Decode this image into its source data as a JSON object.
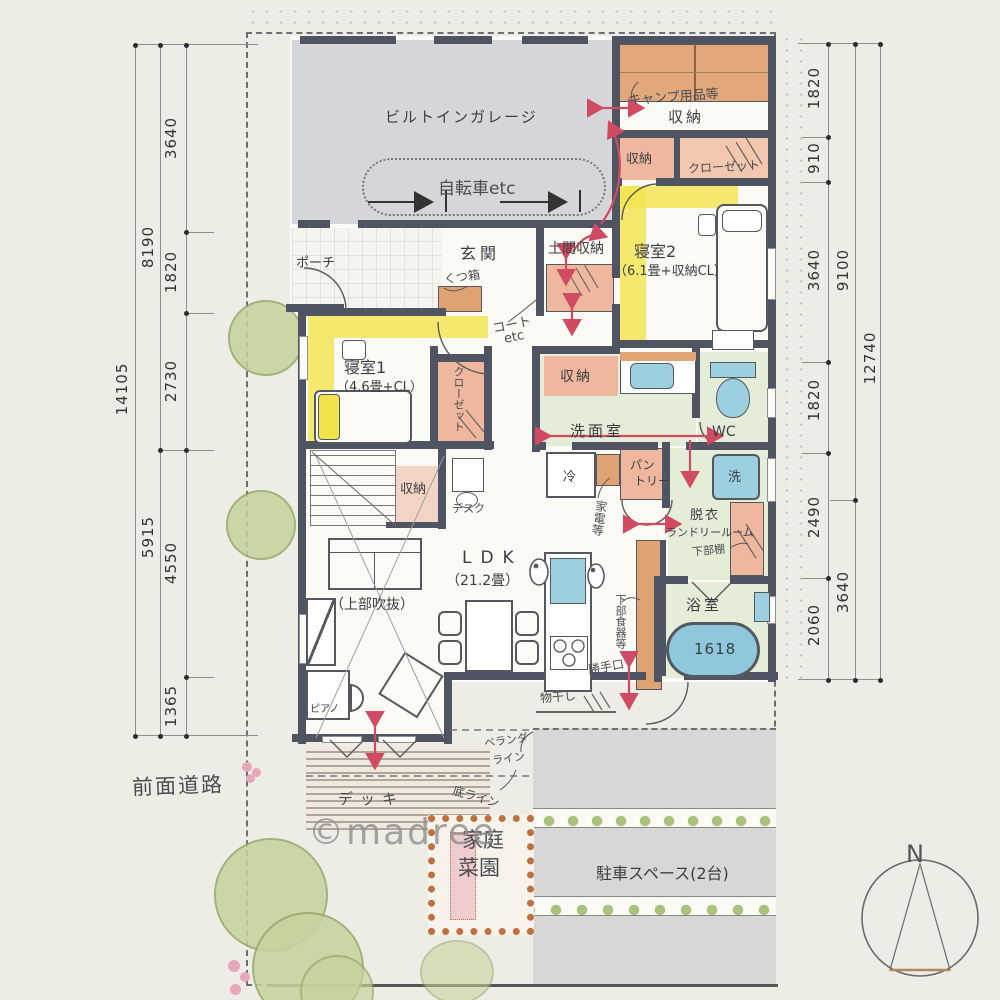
{
  "dims": {
    "left_inner": [
      "3640",
      "1820",
      "2730",
      "4550",
      "1365"
    ],
    "left_mid": [
      "8190",
      "5915"
    ],
    "left_outer": [
      "14105"
    ],
    "right_inner": [
      "1820",
      "910",
      "3640",
      "1820",
      "2490",
      "2060"
    ],
    "right_mid": [
      "9100",
      "3640"
    ],
    "right_outer": [
      "12740"
    ]
  },
  "labels": {
    "garage": "ビルトインガレージ",
    "bicycle": "自転車etc",
    "porch": "ポーチ",
    "entrance": "玄関",
    "shoe_box": "くつ箱",
    "doma_storage": "土間収納",
    "coat1": "コート",
    "coat2": "etc",
    "camp1": "キャンプ用品等",
    "storage": "収納",
    "closet": "クローゼット",
    "bedroom2_name": "寝室2",
    "bedroom2_size": "（6.1畳+収納CL）",
    "bedroom1_name": "寝室1",
    "bedroom1_size": "（4.6畳+CL）",
    "desk": "デスク",
    "washroom": "洗面室",
    "wc": "WC",
    "fridge": "冷",
    "pantry1": "パン",
    "pantry2": "トリー",
    "appliances": "家電等",
    "laundry1": "脱衣",
    "laundry2": "ランドリールーム",
    "lower_shelf": "下部棚",
    "washer": "洗",
    "bathroom": "浴室",
    "tub_size": "1618",
    "ldk_name": "LDK",
    "ldk_size": "（21.2畳）",
    "atrium": "（上部吹抜）",
    "piano": "ピアノ",
    "cupboard": "下部食器等",
    "back_door": "勝手口",
    "drying": "物干し",
    "deck": "デッキ",
    "veranda1": "ベランダ",
    "veranda2": "ライン",
    "bottom_line": "底ライン",
    "garden1": "家庭",
    "garden2": "菜園",
    "parking": "駐車スペース(2台)",
    "front_road": "前面道路",
    "compass_n": "N",
    "watermark": "©madree"
  },
  "colors": {
    "wall": "#4e5461",
    "room_gray": "#d5d6d9",
    "highlight_yellow": "#f2e34d",
    "closet_salmon": "#efb79e",
    "wet_green": "#e4edd8",
    "fixture_blue": "#9ccfe0",
    "arrow_red": "#d04a63",
    "garden_orange": "#bf7040",
    "tree_green": "#c6d39c"
  }
}
